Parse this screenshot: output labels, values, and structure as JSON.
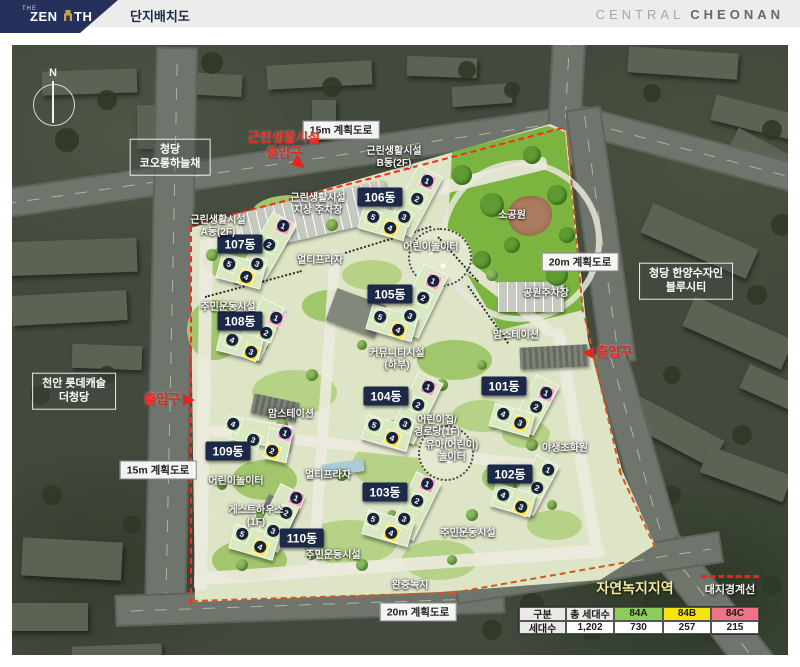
{
  "header": {
    "logo_the": "THE",
    "logo_zen": "ZEN",
    "logo_th": "TH",
    "title": "단지배치도",
    "brand_light": "CENTRAL",
    "brand_bold": "CHEONAN"
  },
  "colors": {
    "navy": "#1c2949",
    "red": "#e8241d",
    "site_green": "#dde5c6",
    "park_green": "#7cb440",
    "type_84a": "#8ccd57",
    "type_84b": "#f6e40e",
    "type_84c": "#ef7385",
    "boundary_orange": "#d2581f"
  },
  "map": {
    "compass": "N",
    "road_labels": [
      {
        "text": "15m 계획도로",
        "x": 341,
        "y": 130
      },
      {
        "text": "20m 계획도로",
        "x": 580,
        "y": 262
      },
      {
        "text": "20m 계획도로",
        "x": 418,
        "y": 612
      },
      {
        "text": "15m 계획도로",
        "x": 158,
        "y": 470
      }
    ],
    "place_labels": [
      {
        "lines": [
          "청당",
          "코오롱하늘채"
        ],
        "x": 170,
        "y": 157
      },
      {
        "lines": [
          "청당 한양수자인",
          "블루시티"
        ],
        "x": 686,
        "y": 281
      },
      {
        "lines": [
          "천안 롯데캐슬",
          "더청당"
        ],
        "x": 74,
        "y": 391
      }
    ],
    "entrances": [
      {
        "lines": [
          "근린생활시설",
          "출입구"
        ],
        "x": 284,
        "y": 146,
        "arrow": "down-right",
        "ax": 293,
        "ay": 158
      },
      {
        "lines": [
          "출입구"
        ],
        "x": 162,
        "y": 400,
        "arrow": "right",
        "ax": 183,
        "ay": 394
      },
      {
        "lines": [
          "출입구"
        ],
        "x": 614,
        "y": 353,
        "arrow": "left",
        "ax": 582,
        "ay": 347
      }
    ],
    "area_labels": [
      {
        "lines": [
          "근린생활시설",
          "지상 주차장"
        ],
        "x": 318,
        "y": 205
      },
      {
        "lines": [
          "근린생활시설",
          "A동(2F)"
        ],
        "x": 218,
        "y": 227
      },
      {
        "lines": [
          "근린생활시설",
          "B동(2F)"
        ],
        "x": 394,
        "y": 158
      },
      {
        "lines": [
          "멀티프라자"
        ],
        "x": 320,
        "y": 261
      },
      {
        "lines": [
          "어린이놀이터"
        ],
        "x": 431,
        "y": 248
      },
      {
        "lines": [
          "소공원"
        ],
        "x": 512,
        "y": 216
      },
      {
        "lines": [
          "공원주차장"
        ],
        "x": 546,
        "y": 294
      },
      {
        "lines": [
          "맘스테이션"
        ],
        "x": 516,
        "y": 336
      },
      {
        "lines": [
          "맘스테이션"
        ],
        "x": 291,
        "y": 415
      },
      {
        "lines": [
          "커뮤니티시설",
          "(하부)"
        ],
        "x": 397,
        "y": 360
      },
      {
        "lines": [
          "주민운동시설"
        ],
        "x": 228,
        "y": 308
      },
      {
        "lines": [
          "어린이집/",
          "경로당(1F)"
        ],
        "x": 437,
        "y": 427
      },
      {
        "lines": [
          "유아(어린이)",
          "놀이터"
        ],
        "x": 452,
        "y": 452
      },
      {
        "lines": [
          "야생초화원"
        ],
        "x": 565,
        "y": 449
      },
      {
        "lines": [
          "게스트하우스",
          "(1F)"
        ],
        "x": 256,
        "y": 517
      },
      {
        "lines": [
          "주민운동시설"
        ],
        "x": 333,
        "y": 556
      },
      {
        "lines": [
          "주민운동시설"
        ],
        "x": 468,
        "y": 534
      },
      {
        "lines": [
          "완충녹지"
        ],
        "x": 410,
        "y": 586
      },
      {
        "lines": [
          "어린이놀이터"
        ],
        "x": 236,
        "y": 482
      },
      {
        "lines": [
          "멀티프라자"
        ],
        "x": 328,
        "y": 476
      }
    ],
    "buildings": [
      {
        "label": "107동",
        "label_x": 240,
        "label_y": 244,
        "wings": [
          [
            268,
            245,
            26,
            62,
            30
          ],
          [
            240,
            270,
            44,
            24,
            15
          ]
        ],
        "units": [
          [
            "1",
            283,
            226,
            "c"
          ],
          [
            "2",
            269,
            245,
            "a"
          ],
          [
            "3",
            257,
            264,
            "a"
          ],
          [
            "5",
            229,
            264,
            "a"
          ],
          [
            "4",
            246,
            277,
            "b"
          ]
        ]
      },
      {
        "label": "106동",
        "label_x": 380,
        "label_y": 197,
        "wings": [
          [
            414,
            200,
            26,
            66,
            28
          ],
          [
            383,
            221,
            46,
            24,
            16
          ]
        ],
        "units": [
          [
            "1",
            427,
            181,
            "c"
          ],
          [
            "2",
            417,
            199,
            "a"
          ],
          [
            "3",
            404,
            217,
            "a"
          ],
          [
            "5",
            373,
            217,
            "a"
          ],
          [
            "4",
            390,
            228,
            "b"
          ]
        ]
      },
      {
        "label": "105동",
        "label_x": 390,
        "label_y": 294,
        "wings": [
          [
            420,
            300,
            26,
            68,
            26
          ],
          [
            391,
            322,
            46,
            24,
            16
          ]
        ],
        "units": [
          [
            "1",
            433,
            281,
            "c"
          ],
          [
            "2",
            423,
            298,
            "a"
          ],
          [
            "3",
            410,
            316,
            "a"
          ],
          [
            "5",
            380,
            317,
            "a"
          ],
          [
            "4",
            398,
            330,
            "b"
          ]
        ]
      },
      {
        "label": "108동",
        "label_x": 240,
        "label_y": 321,
        "wings": [
          [
            260,
            328,
            24,
            56,
            26
          ],
          [
            239,
            343,
            42,
            22,
            14
          ]
        ],
        "units": [
          [
            "1",
            276,
            318,
            "c"
          ],
          [
            "2",
            266,
            333,
            "a"
          ],
          [
            "3",
            251,
            352,
            "b"
          ],
          [
            "4",
            232,
            340,
            "a"
          ]
        ]
      },
      {
        "label": "104동",
        "label_x": 386,
        "label_y": 396,
        "wings": [
          [
            415,
            407,
            26,
            66,
            26
          ],
          [
            386,
            432,
            46,
            24,
            16
          ]
        ],
        "units": [
          [
            "1",
            428,
            387,
            "c"
          ],
          [
            "2",
            418,
            405,
            "a"
          ],
          [
            "3",
            405,
            424,
            "a"
          ],
          [
            "5",
            374,
            425,
            "a"
          ],
          [
            "4",
            392,
            438,
            "b"
          ]
        ]
      },
      {
        "label": "101동",
        "label_x": 504,
        "label_y": 386,
        "wings": [
          [
            534,
            404,
            24,
            54,
            28
          ],
          [
            511,
            419,
            40,
            22,
            16
          ]
        ],
        "units": [
          [
            "1",
            546,
            393,
            "c"
          ],
          [
            "2",
            536,
            407,
            "a"
          ],
          [
            "3",
            520,
            423,
            "b"
          ],
          [
            "4",
            503,
            414,
            "a"
          ]
        ]
      },
      {
        "label": "103동",
        "label_x": 385,
        "label_y": 492,
        "wings": [
          [
            414,
            505,
            26,
            62,
            26
          ],
          [
            387,
            527,
            46,
            24,
            16
          ]
        ],
        "units": [
          [
            "1",
            427,
            484,
            "c"
          ],
          [
            "2",
            417,
            501,
            "a"
          ],
          [
            "3",
            404,
            519,
            "a"
          ],
          [
            "5",
            373,
            519,
            "a"
          ],
          [
            "4",
            391,
            533,
            "b"
          ]
        ]
      },
      {
        "label": "109동",
        "label_x": 228,
        "label_y": 451,
        "wings": [
          [
            260,
            432,
            58,
            22,
            10
          ],
          [
            277,
            444,
            22,
            30,
            12
          ]
        ],
        "units": [
          [
            "1",
            285,
            433,
            "c"
          ],
          [
            "2",
            272,
            451,
            "b"
          ],
          [
            "3",
            253,
            440,
            "a"
          ],
          [
            "4",
            233,
            424,
            "a"
          ]
        ]
      },
      {
        "label": "110동",
        "label_x": 302,
        "label_y": 538,
        "wings": [
          [
            278,
            517,
            26,
            62,
            26
          ],
          [
            253,
            541,
            44,
            24,
            16
          ]
        ],
        "units": [
          [
            "1",
            296,
            498,
            "c"
          ],
          [
            "2",
            286,
            513,
            "a"
          ],
          [
            "3",
            273,
            531,
            "a"
          ],
          [
            "5",
            242,
            534,
            "a"
          ],
          [
            "4",
            260,
            547,
            "b"
          ]
        ]
      },
      {
        "label": "102동",
        "label_x": 510,
        "label_y": 474,
        "wings": [
          [
            534,
            484,
            24,
            54,
            28
          ],
          [
            512,
            499,
            40,
            22,
            16
          ]
        ],
        "units": [
          [
            "1",
            548,
            470,
            "a"
          ],
          [
            "2",
            537,
            488,
            "a"
          ],
          [
            "3",
            521,
            507,
            "b"
          ],
          [
            "4",
            503,
            495,
            "a"
          ]
        ]
      }
    ]
  },
  "legend": {
    "green_label": "자연녹지지역",
    "red_label": "대지경계선"
  },
  "table": {
    "header": [
      "구분",
      "총 세대수",
      "84A",
      "84B",
      "84C"
    ],
    "row_label": "세대수",
    "values": [
      "1,202",
      "730",
      "257",
      "215"
    ]
  }
}
